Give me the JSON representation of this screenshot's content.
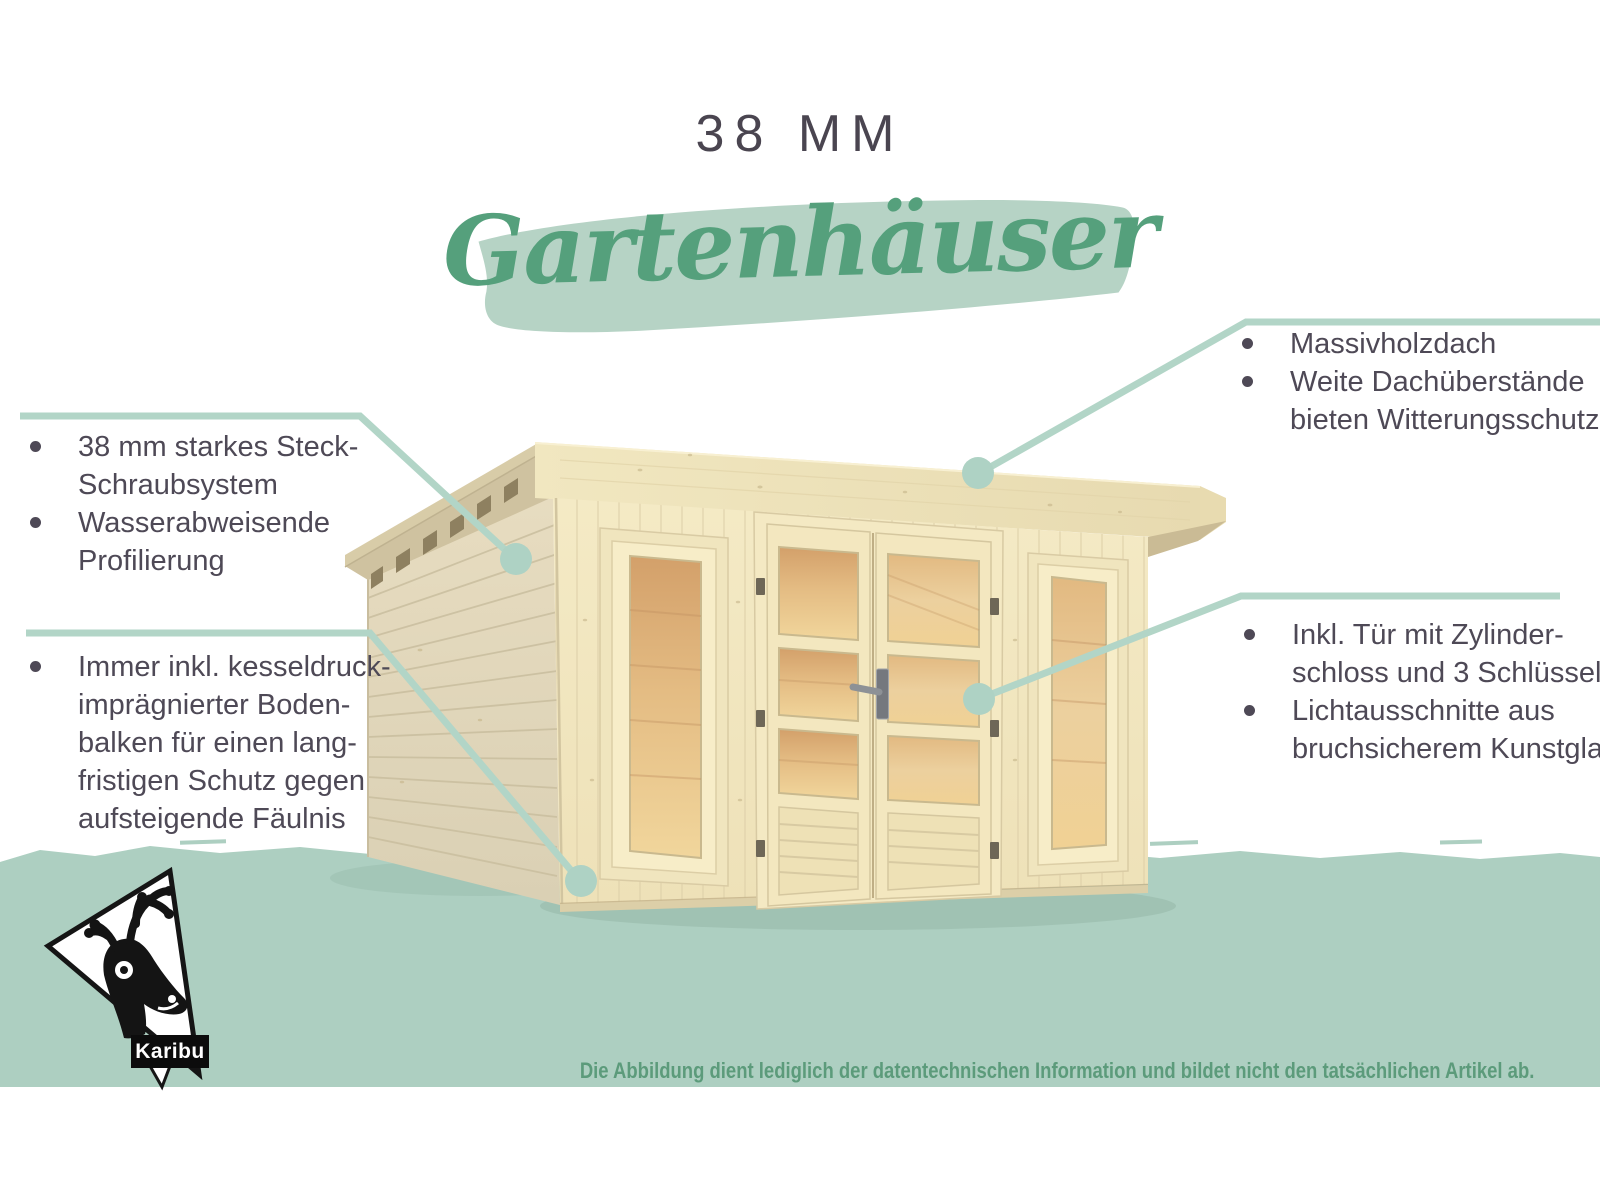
{
  "header": {
    "category": "38 MM",
    "title": "Gartenhäuser"
  },
  "callouts": {
    "left_top": {
      "items": [
        [
          "38 mm starkes Steck-",
          "Schraubsystem"
        ],
        [
          "Wasserabweisende",
          "Profilierung"
        ]
      ]
    },
    "left_bottom": {
      "items": [
        [
          "Immer inkl. kesseldruck-",
          "imprägnierter Boden-",
          "balken für einen lang-",
          "fristigen Schutz gegen",
          "aufsteigende Fäulnis"
        ]
      ]
    },
    "right_top": {
      "items": [
        [
          "Massivholzdach"
        ],
        [
          "Weite Dachüberstände",
          "bieten Witterungsschutz"
        ]
      ]
    },
    "right_bottom": {
      "items": [
        [
          "Inkl. Tür mit Zylinder-",
          "schloss und 3 Schlüsseln"
        ],
        [
          "Lichtausschnitte aus",
          "bruchsicherem Kunstglas"
        ]
      ]
    }
  },
  "brand": {
    "logo_label": "Karibu",
    "logo_icon": "karibu-deer-logo"
  },
  "footer": {
    "disclaimer": "Die Abbildung dient lediglich der datentechnischen Information und bildet nicht den tatsächlichen Artikel ab."
  },
  "colors": {
    "band": "#adcfc1",
    "callout_line": "#b2d5c7",
    "heading_text": "#4a4550",
    "body_text": "#4e4956",
    "script_green": "#55a07c",
    "brush": "#b6d3c5",
    "disclaimer_green": "#5c9b7b",
    "wood_front": "#f2e7c1",
    "wood_side": "#e2d8bc",
    "glass_amber": "#e4bc83",
    "logo_black": "#0c0c0c"
  }
}
